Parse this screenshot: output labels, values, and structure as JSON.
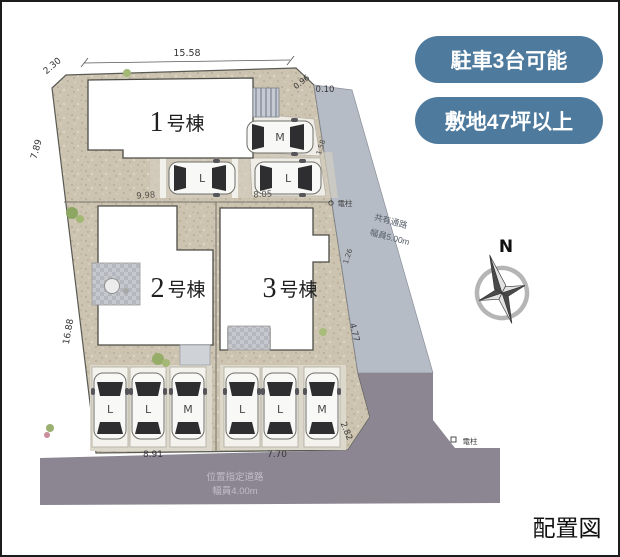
{
  "badges": {
    "b1": "駐車3台可能",
    "b2": "敷地47坪以上"
  },
  "buildings": {
    "b1": {
      "num": "1",
      "suffix": "号棟"
    },
    "b2": {
      "num": "2",
      "suffix": "号棟"
    },
    "b3": {
      "num": "3",
      "suffix": "号棟"
    }
  },
  "roads": {
    "front_line1": "位置指定道路",
    "front_line2": "幅員4.00m",
    "shared_line1": "共有通路",
    "shared_line2": "幅員5.00m"
  },
  "dims": {
    "top": "15.58",
    "corner_tl": "2.30",
    "left_upper": "7.89",
    "left_lower": "16.88",
    "lot1_width": "9.98",
    "lot2_width": "8.05",
    "corner_tr_a": "0.96",
    "corner_tr_b": "0.10",
    "right_upper": "1.58",
    "right_mid": "1.26",
    "right_lower": "4.77",
    "park_left": "8.91",
    "park_right": "7.70",
    "corner_br": "2.82"
  },
  "poles": {
    "p1": "電柱",
    "p2": "電柱"
  },
  "cars": {
    "upper": "M",
    "mid1": "L",
    "mid2": "L",
    "s1": "L",
    "s2": "L",
    "s3": "M",
    "s4": "L",
    "s5": "L",
    "s6": "M"
  },
  "compass": {
    "n": "N"
  },
  "caption": "配置図",
  "colors": {
    "badge": "#4e7a9d",
    "plot": "#ccc3b0",
    "corridor": "#b6bcc5",
    "road": "#8b8692"
  }
}
